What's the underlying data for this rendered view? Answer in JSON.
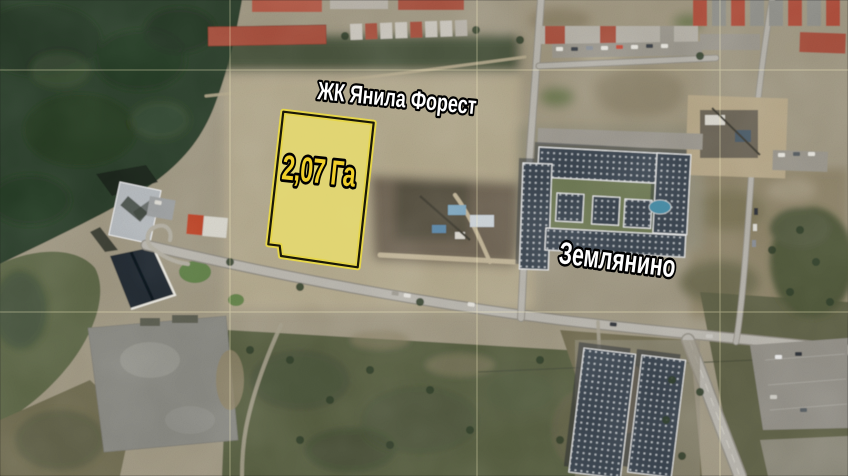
{
  "map": {
    "view": "satellite",
    "labels": {
      "residential_complex": "ЖК Янила Форест",
      "district": "Землянино"
    },
    "plot": {
      "area_label": "2,07 Га",
      "area_hectares": 2.07,
      "fill_color": "#ece06e",
      "outline_outer_color": "#f2e13c",
      "outline_inner_color": "#1a1808",
      "label_color": "#f0cf2a"
    },
    "label_style": {
      "text_color": "#ffffff",
      "outline_color": "#000000"
    },
    "grid_color": "#fff8c8"
  }
}
